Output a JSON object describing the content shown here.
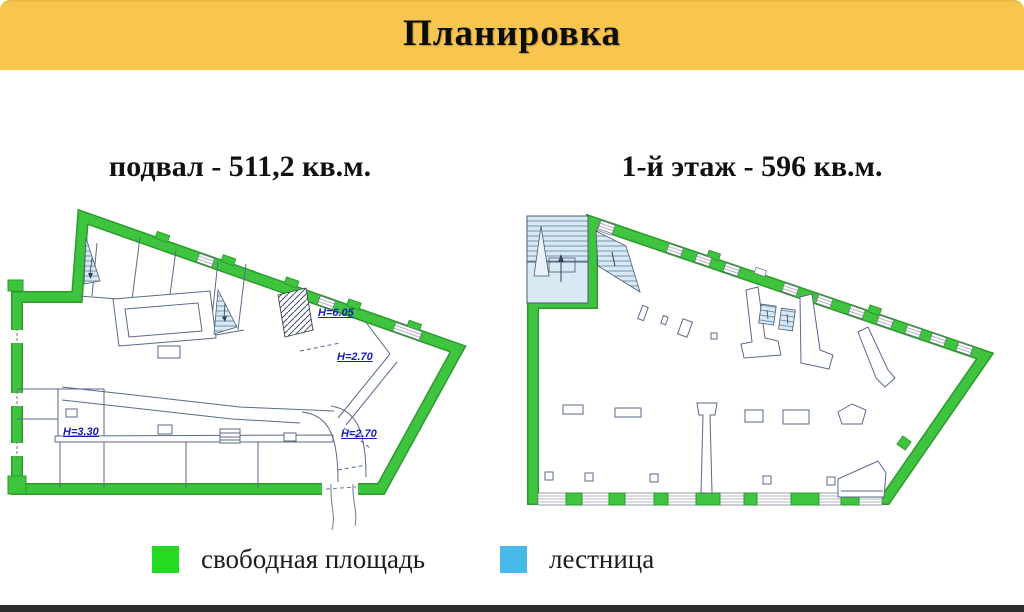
{
  "header": {
    "title": "Планировка",
    "background": "#F8C64E"
  },
  "plans": {
    "basement": {
      "title": "подвал - 511,2 кв.м.",
      "height_labels": [
        "H=6.05",
        "H=2.70",
        "H=3.30",
        "H=2.70"
      ]
    },
    "first_floor": {
      "title": "1-й этаж - 596 кв.м."
    }
  },
  "legend": {
    "items": [
      {
        "id": "free-area",
        "label": "свободная площадь",
        "color": "#22DB22"
      },
      {
        "id": "stairs",
        "label": "лестница",
        "color": "#47B9EA"
      }
    ]
  },
  "palette": {
    "wall_green": "#3EC43E",
    "wall_green_dark": "#2C9B2C",
    "stair_fill": "#D7E9F2",
    "label_blue": "#1A1AB8"
  }
}
